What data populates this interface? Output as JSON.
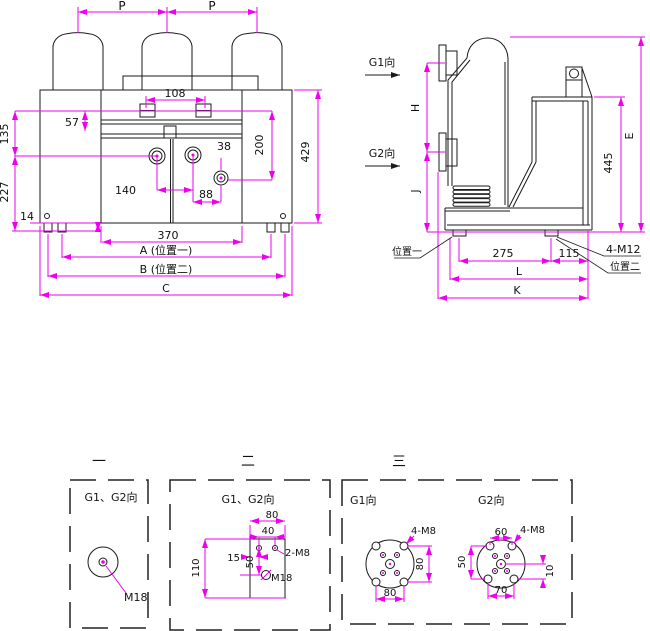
{
  "front": {
    "pole_pitch_left": "P",
    "pole_pitch_right": "P",
    "d108": "108",
    "d57": "57",
    "d135": "135",
    "d227": "227",
    "d14": "14",
    "d38": "38",
    "d200": "200",
    "d429": "429",
    "d140": "140",
    "d88": "88",
    "d370": "370",
    "dA": "A (位置一)",
    "dB": "B (位置二)",
    "dC": "C"
  },
  "side": {
    "g1_label": "G1向",
    "g2_label": "G2向",
    "dH": "H",
    "dJ": "J",
    "dE": "E",
    "d445": "445",
    "d275": "275",
    "d115": "115",
    "dL": "L",
    "dK": "K",
    "bolt_label": "4-M12",
    "pos1_label": "位置一",
    "pos2_label": "位置二"
  },
  "views": {
    "v1": {
      "title": "一",
      "direction_label": "G1、G2向",
      "thread_label": "M18"
    },
    "v2": {
      "title": "二",
      "direction_label": "G1、G2向",
      "d80": "80",
      "d40": "40",
      "d15": "15",
      "d50": "50",
      "d110": "110",
      "bolt_label": "2-M8",
      "thread_label": "M18"
    },
    "v3": {
      "title": "三",
      "g1_label": "G1向",
      "g2_label": "G2向",
      "g1_bolt": "4-M8",
      "g1_d80v": "80",
      "g1_d80h": "80",
      "g2_d60": "60",
      "g2_bolt": "4-M8",
      "g2_d50": "50",
      "g2_d10": "10",
      "g2_d70": "70"
    }
  },
  "colors": {
    "dimension_line": "#EE00EE",
    "drawing_line": "#1A1A1A",
    "background": "#FFFFFF"
  }
}
